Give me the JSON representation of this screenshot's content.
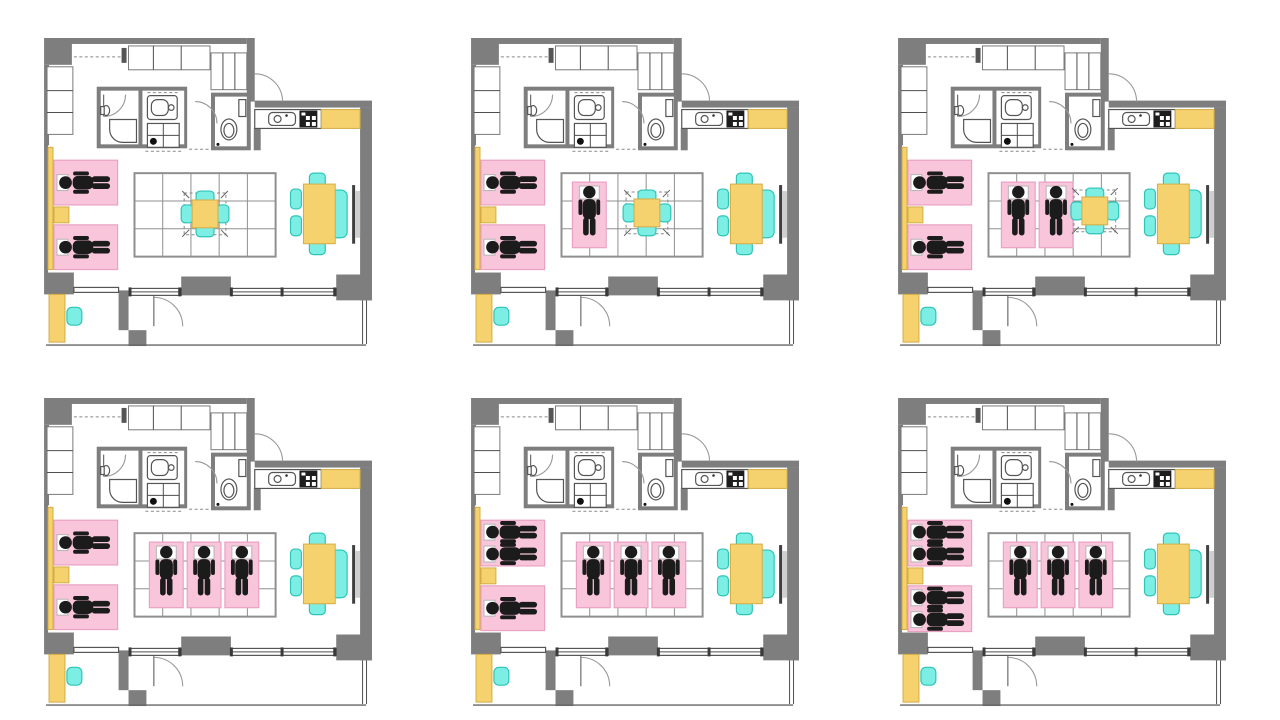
{
  "page": {
    "title": "apartment-occupancy-floor-plans",
    "background": "#ffffff",
    "grid_rows": 2,
    "grid_cols": 3
  },
  "colors": {
    "wall": "#7e7e7e",
    "line": "#4f4f4f",
    "fixture_line": "#555555",
    "bed_pink": "#f9c5da",
    "bed_pink_border": "#e9a2c4",
    "accent_yellow": "#f5d26e",
    "accent_yellow_border": "#d4ac45",
    "chair_cyan": "#7ceee4",
    "chair_cyan_border": "#2ec4b8",
    "figure_black": "#1b1b1b",
    "tatami_line": "#8f8f8f",
    "window_glass": "#3f3f3f"
  },
  "panels": [
    {
      "name": "plan-1",
      "position": "top-left",
      "occupants_total": 2,
      "bed_occupants": [
        1,
        1
      ],
      "futon_count": 0,
      "low_table": {
        "present": true,
        "position": "center"
      }
    },
    {
      "name": "plan-2",
      "position": "top-center",
      "occupants_total": 3,
      "bed_occupants": [
        1,
        1
      ],
      "futon_count": 1,
      "low_table": {
        "present": true,
        "position": "right-of-center"
      }
    },
    {
      "name": "plan-3",
      "position": "top-right",
      "occupants_total": 4,
      "bed_occupants": [
        1,
        1
      ],
      "futon_count": 2,
      "low_table": {
        "present": true,
        "position": "right"
      }
    },
    {
      "name": "plan-4",
      "position": "bottom-left",
      "occupants_total": 5,
      "bed_occupants": [
        1,
        1
      ],
      "futon_count": 3,
      "low_table": {
        "present": false,
        "position": null
      }
    },
    {
      "name": "plan-5",
      "position": "bottom-center",
      "occupants_total": 6,
      "bed_occupants": [
        2,
        1
      ],
      "futon_count": 3,
      "low_table": {
        "present": false,
        "position": null
      }
    },
    {
      "name": "plan-6",
      "position": "bottom-right",
      "occupants_total": 7,
      "bed_occupants": [
        2,
        2
      ],
      "futon_count": 3,
      "low_table": {
        "present": false,
        "position": null
      }
    }
  ]
}
